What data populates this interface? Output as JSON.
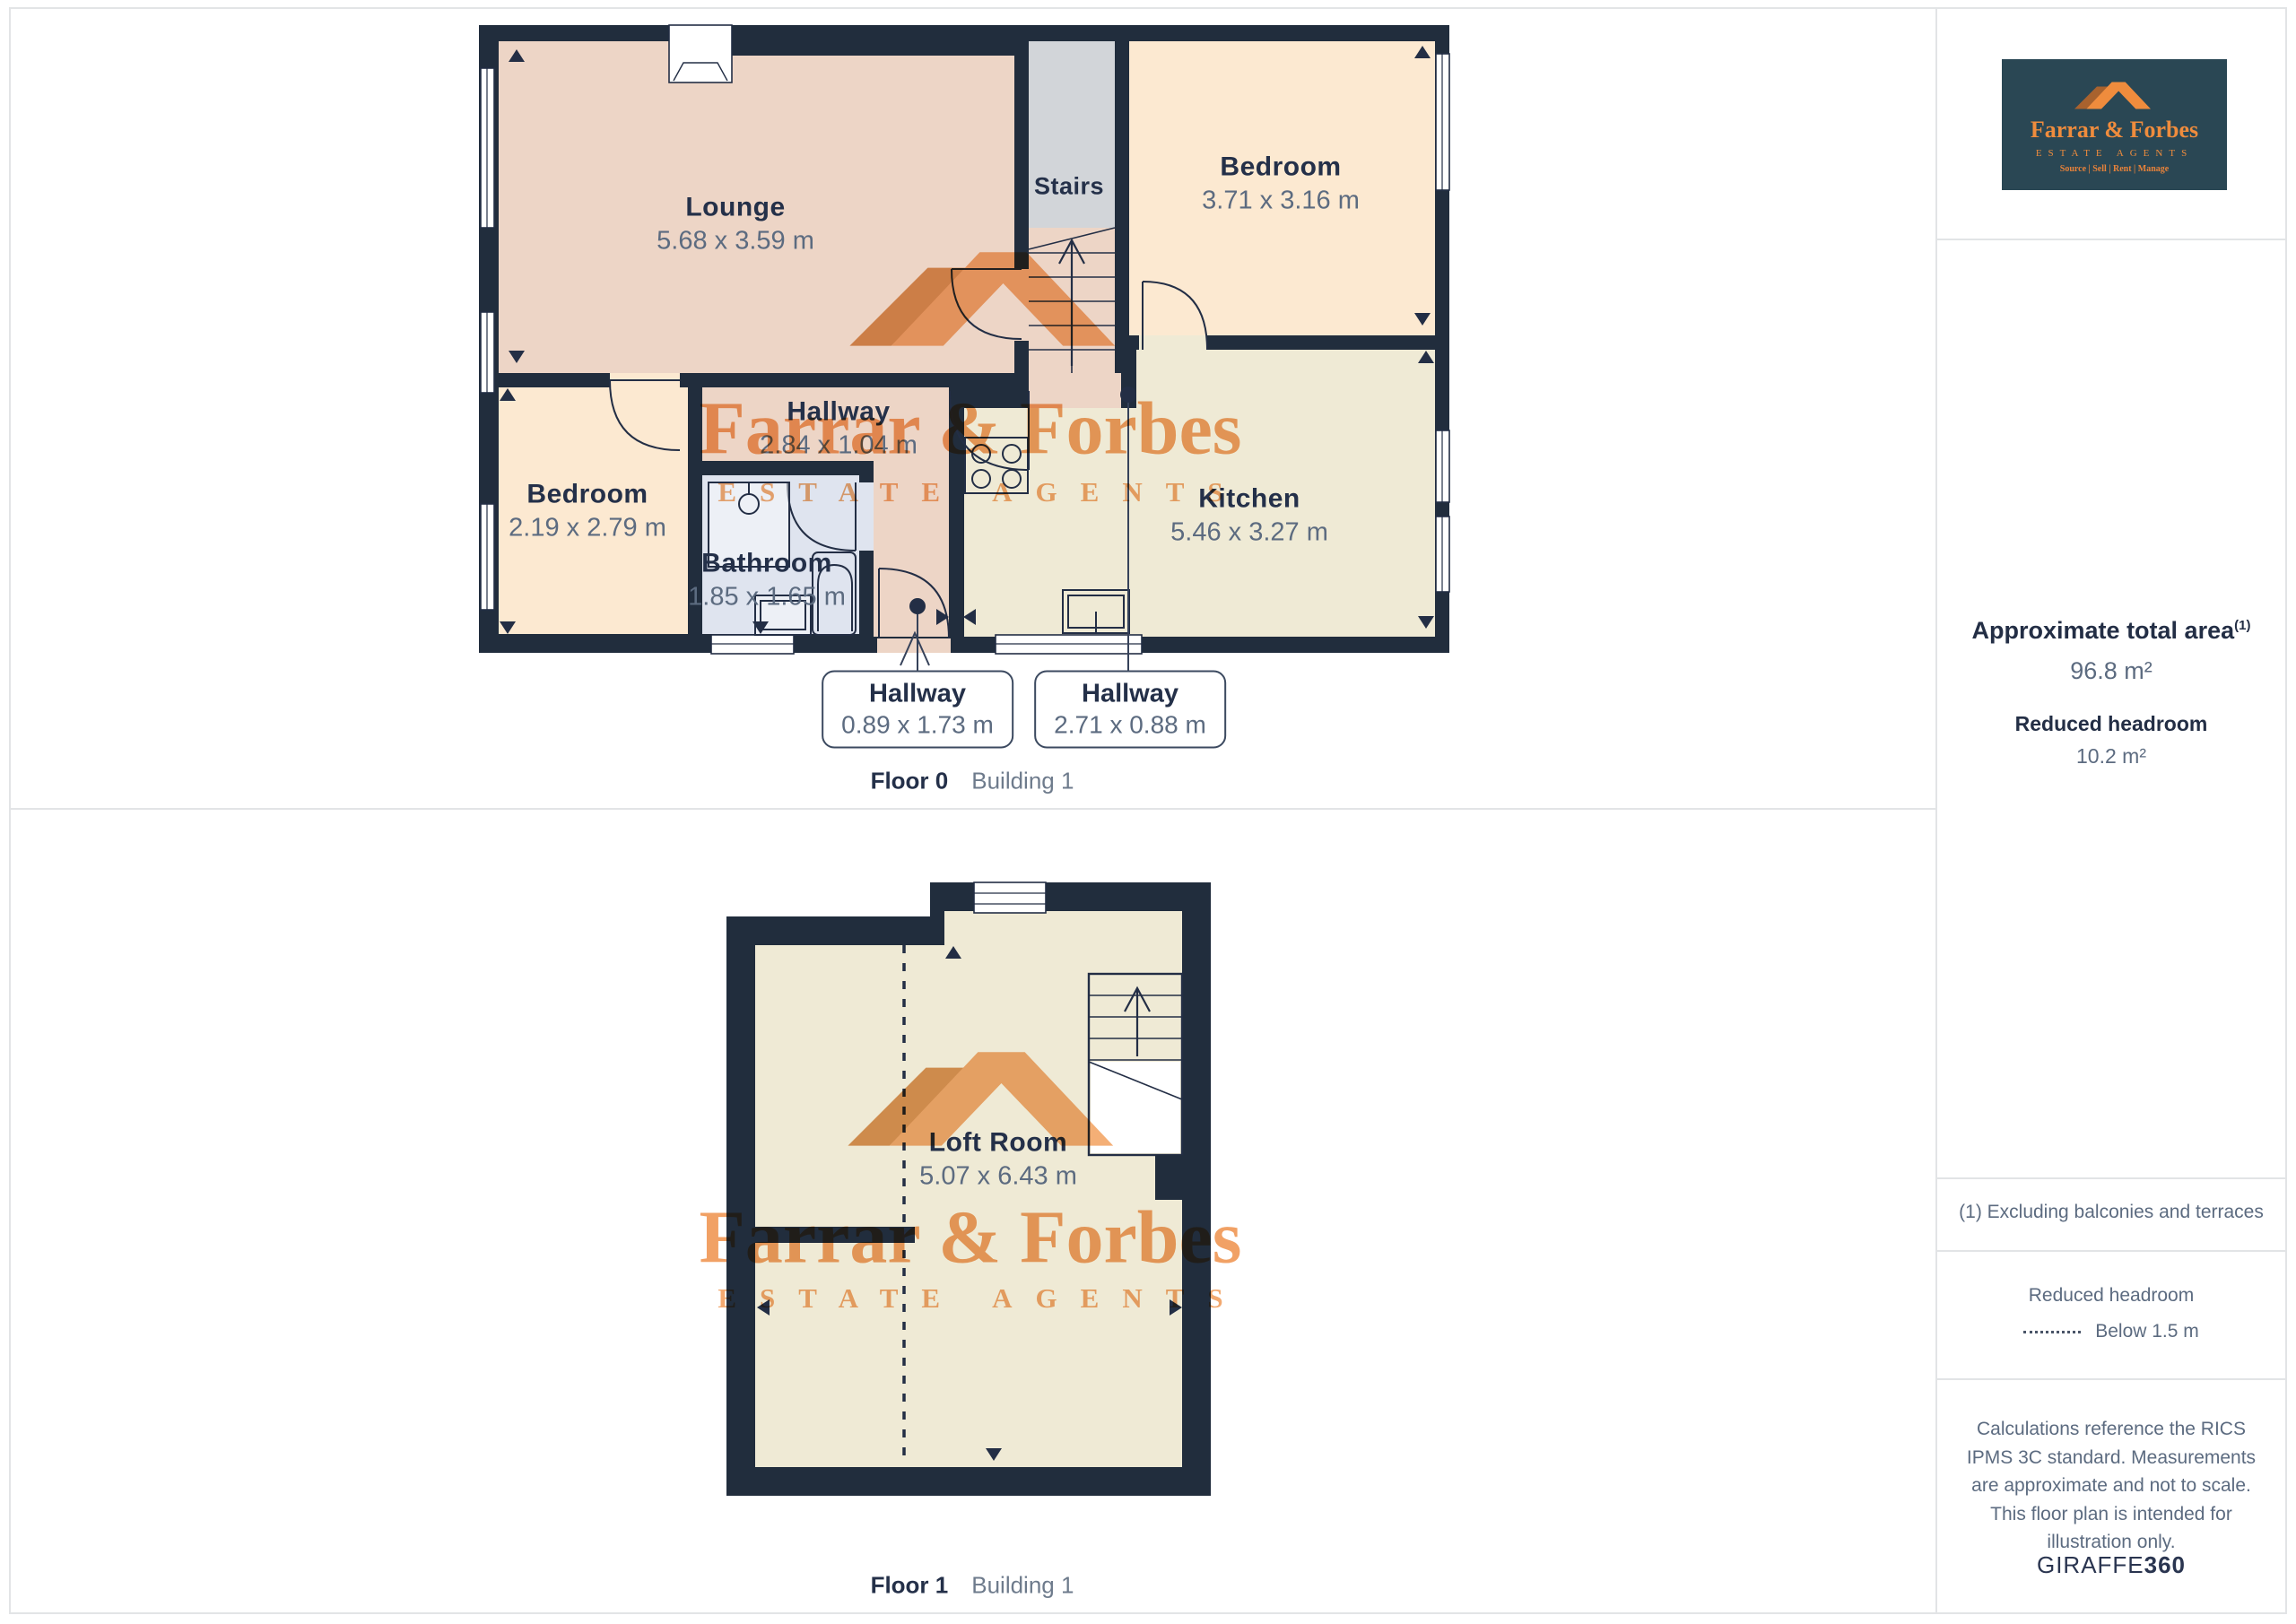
{
  "brand": {
    "name": "Farrar & Forbes",
    "tagline": "ESTATE AGENTS",
    "services": "Source | Sell | Rent | Manage",
    "watermark_name": "Farrar & Forbes",
    "watermark_tagline": "E S T A T E   A G E N T S",
    "accent_orange": "#ef8c3d",
    "logo_bg": "#2a4754"
  },
  "sidebar": {
    "area_title": "Approximate total area",
    "area_sup": "(1)",
    "area_value": "96.8 m²",
    "headroom_title": "Reduced headroom",
    "headroom_value": "10.2 m²",
    "note": "(1) Excluding balconies and terraces",
    "legend_title": "Reduced headroom",
    "legend_value": "Below 1.5 m",
    "disclaimer": "Calculations reference the RICS IPMS 3C standard. Measurements are approximate and not to scale. This floor plan is intended for illustration only.",
    "footer_regular": "GIRAFFE",
    "footer_bold": "360"
  },
  "floor0": {
    "caption_floor": "Floor 0",
    "caption_building": "Building 1",
    "rooms": {
      "lounge": {
        "name": "Lounge",
        "dims": "5.68 x 3.59 m"
      },
      "bedroom_right": {
        "name": "Bedroom",
        "dims": "3.71 x 3.16 m"
      },
      "bedroom_left": {
        "name": "Bedroom",
        "dims": "2.19 x 2.79 m"
      },
      "bathroom": {
        "name": "Bathroom",
        "dims": "1.85 x 1.65 m"
      },
      "kitchen": {
        "name": "Kitchen",
        "dims": "5.46 x 3.27 m"
      },
      "hallway": {
        "name": "Hallway",
        "dims": "2.84 x 1.04 m"
      },
      "stairs": {
        "name": "Stairs"
      }
    },
    "callouts": [
      {
        "name": "Hallway",
        "dims": "0.89 x 1.73 m"
      },
      {
        "name": "Hallway",
        "dims": "2.71 x 0.88 m"
      }
    ]
  },
  "floor1": {
    "caption_floor": "Floor 1",
    "caption_building": "Building 1",
    "rooms": {
      "loft": {
        "name": "Loft Room",
        "dims": "5.07 x 6.43 m"
      }
    }
  },
  "colors": {
    "wall": "#212d3d",
    "room_pink": "#edd5c6",
    "room_cream": "#fce9d1",
    "room_pale": "#efead5",
    "room_blue": "#dfe4ef",
    "stairs_gray": "#d2d5d9",
    "label_dark": "#243049",
    "label_gray": "#5c6b80",
    "watermark_orange": "#f09a58"
  }
}
